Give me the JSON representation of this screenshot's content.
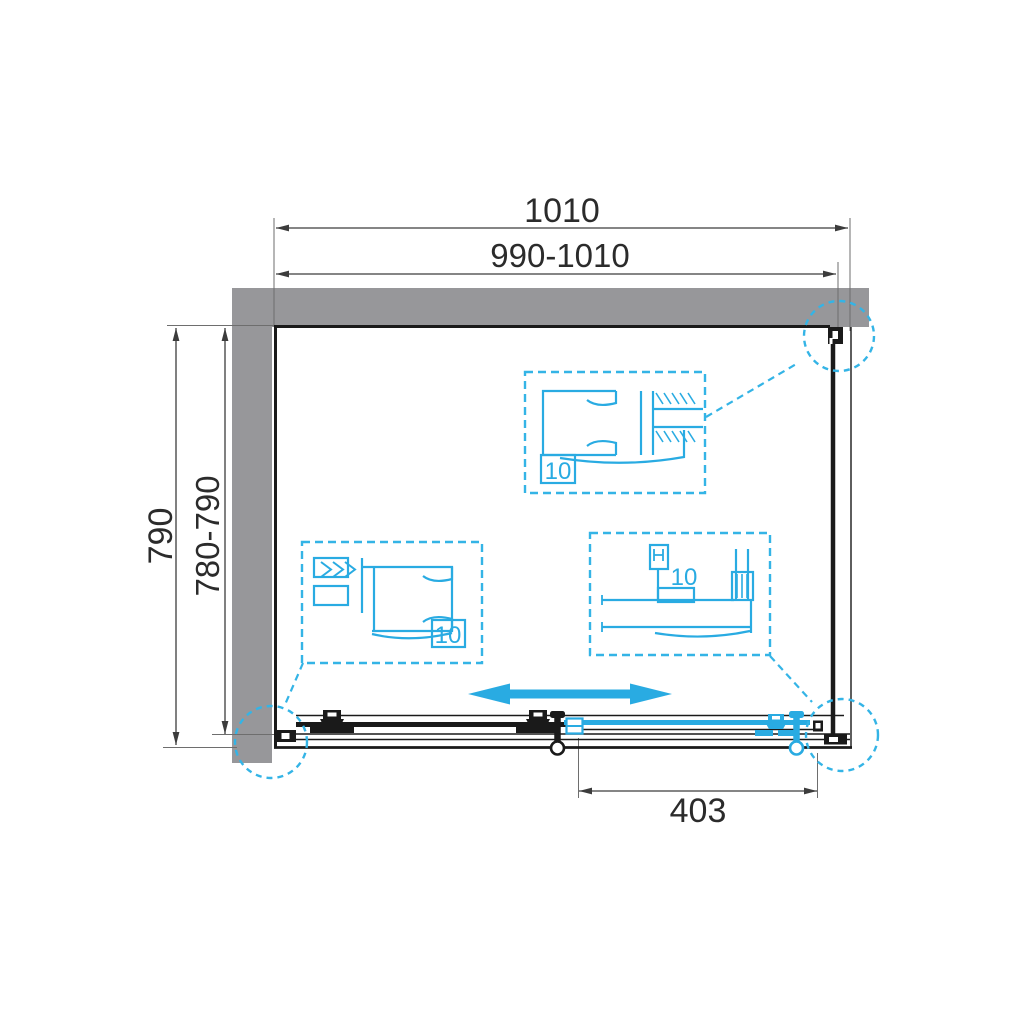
{
  "drawing": {
    "type": "shower-enclosure-plan-view",
    "colors": {
      "accent_cyan": "#29ABE2",
      "wall_gray": "#97979A",
      "line_black": "#1A1A1A",
      "dim_gray": "#3C3C3C"
    },
    "dimensions": {
      "top_overall": "1010",
      "top_adjustable": "990-1010",
      "side_overall": "790",
      "side_adjustable": "780-790",
      "door_panel": "403"
    },
    "details": {
      "top_profile_glass": "10",
      "left_profile_glass": "10",
      "bottom_rail_glass": "10"
    },
    "icons": {
      "slide_direction": "double-headed-arrow",
      "callouts": "dashed-detail-circles"
    }
  }
}
